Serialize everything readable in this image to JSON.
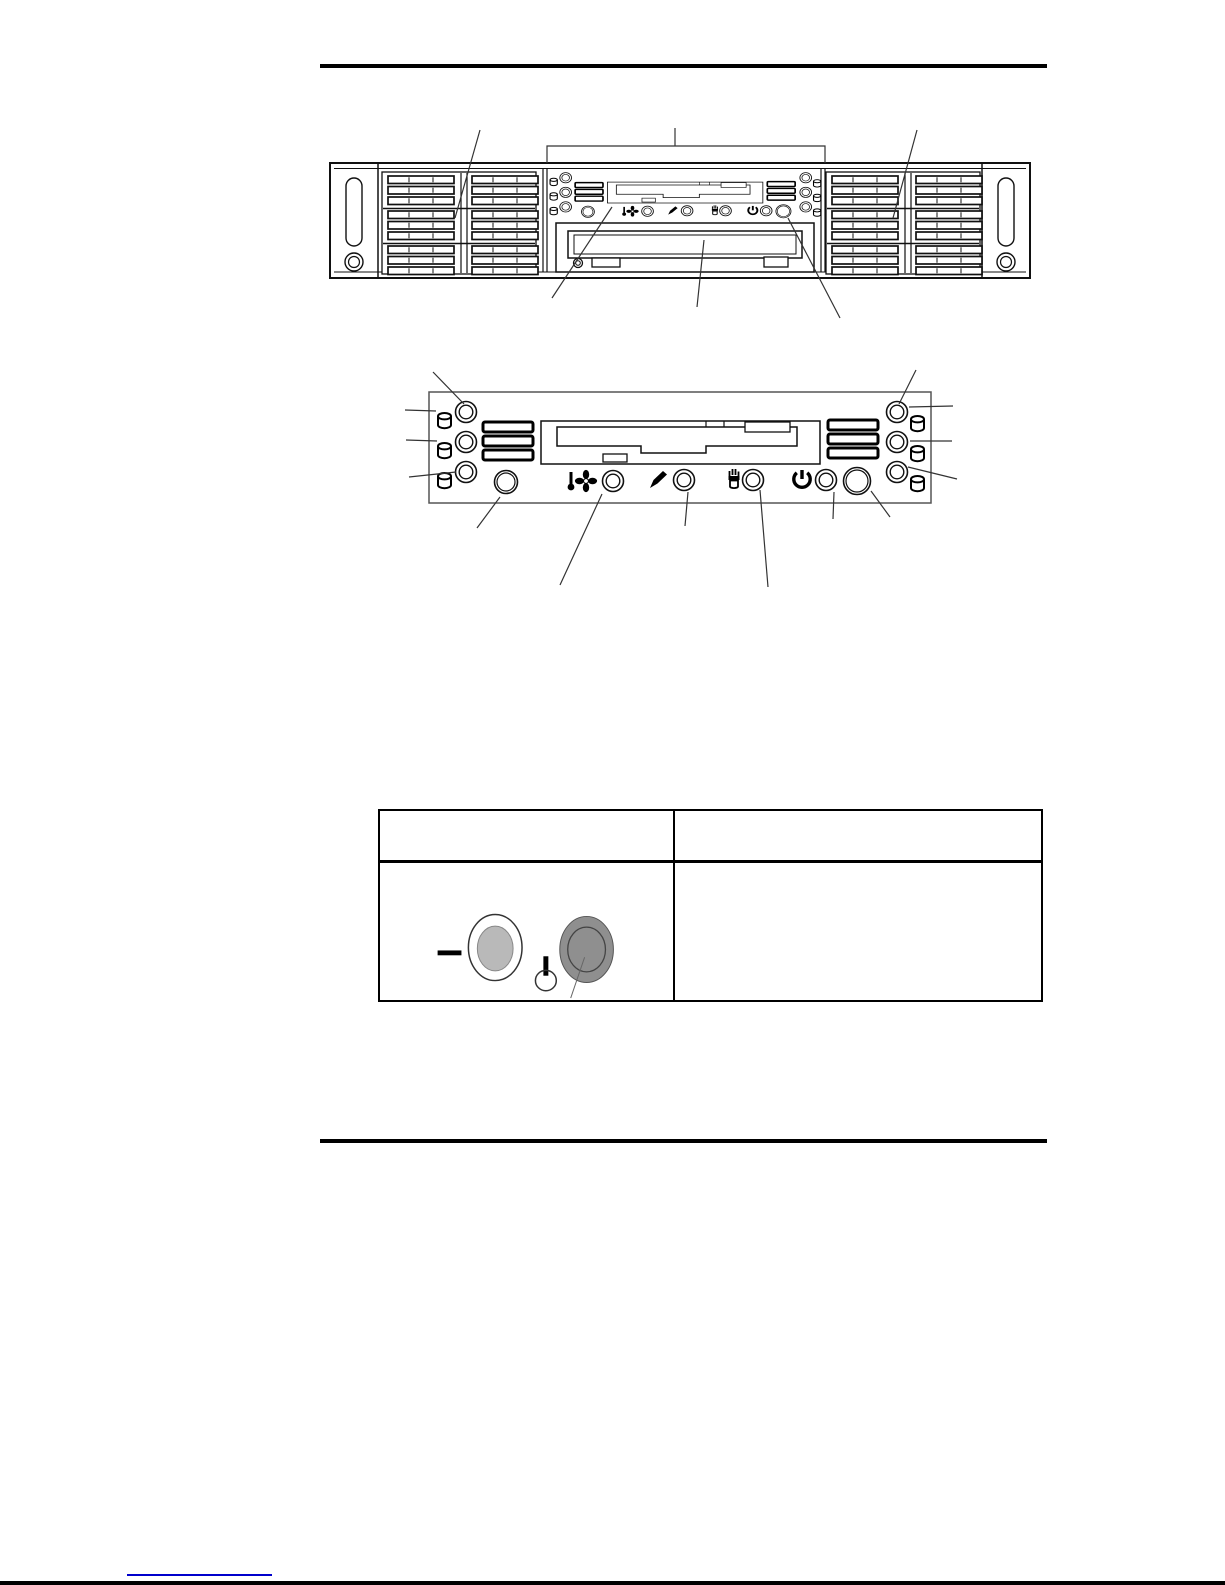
{
  "page": {
    "type": "hardware-manual-page",
    "background_color": "#ffffff",
    "rule_color": "#000000"
  },
  "figures": {
    "front_view": {
      "name": "server-front-view",
      "components": [
        "left-rack-ear",
        "left-hot-swap-drive-bays",
        "control-panel",
        "diskette-drive",
        "cd-rom-drive",
        "right-hot-swap-drive-bays",
        "right-rack-ear"
      ],
      "callouts": [
        "control-panel-bracket",
        "left-drive-bay-leader",
        "right-drive-bay-leader",
        "diskette-drive-leader",
        "cd-rom-drive-leader",
        "power-button-leader"
      ]
    },
    "control_panel_detail": {
      "name": "control-panel-detail-view",
      "left_disk_leds": 3,
      "right_disk_leds": 3,
      "status_icons": [
        "disk-cylinder-icon",
        "fan-temperature-icon",
        "nmi-pen-icon",
        "disk-fail-hand-icon",
        "power-icon"
      ],
      "buttons": [
        "reset-button",
        "power-button"
      ]
    }
  },
  "table": {
    "header": [
      "",
      ""
    ],
    "body_rows": [
      [
        "",
        ""
      ]
    ],
    "illustration": {
      "dash_color": "#000000",
      "secondary_button_color": "#b9b9b9",
      "power_button_color": "#8f8f8f",
      "power_on_symbol": "line-and-circle"
    }
  },
  "footer": {
    "link_label": "",
    "link_color": "#0000cc"
  }
}
